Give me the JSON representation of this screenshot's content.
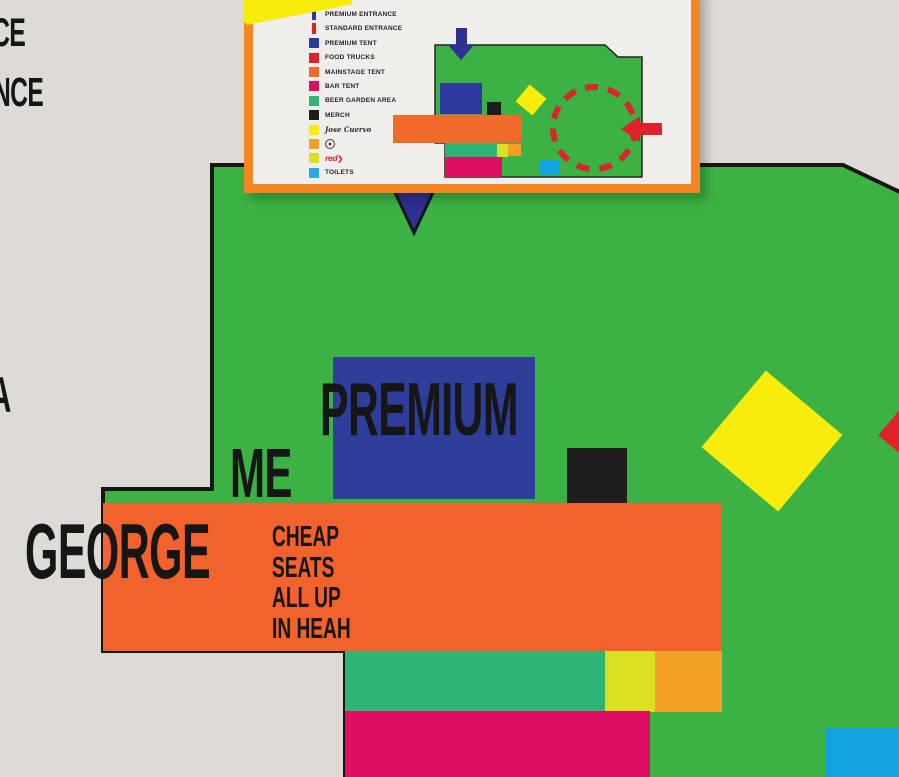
{
  "inset_legend": {
    "items": [
      {
        "label": "PREMIUM ENTRANCE",
        "swatch": "bar",
        "swatch_color": "#2c3a9e"
      },
      {
        "label": "STANDARD ENTRANCE",
        "swatch": "bar",
        "swatch_color": "#e0212a"
      },
      {
        "label": "PREMIUM TENT",
        "swatch": "square",
        "swatch_color": "#2c3a9e"
      },
      {
        "label": "FOOD TRUCKS",
        "swatch": "square",
        "swatch_color": "#e0212a"
      },
      {
        "label": "MAINSTAGE TENT",
        "swatch": "square",
        "swatch_color": "#f26a2b"
      },
      {
        "label": "BAR TENT",
        "swatch": "square",
        "swatch_color": "#e00e63"
      },
      {
        "label": "BEER GARDEN AREA",
        "swatch": "square",
        "swatch_color": "#2fb573"
      },
      {
        "label": "MERCH",
        "swatch": "square",
        "swatch_color": "#1c1c1c"
      },
      {
        "label": "Jose Cuervo",
        "swatch": "square",
        "swatch_color": "#f9ed0a",
        "type": "script-logo"
      },
      {
        "label": "",
        "swatch": "square",
        "swatch_color": "#f3a126",
        "type": "circle-logo"
      },
      {
        "label": "red",
        "swatch": "square",
        "swatch_color": "#d9e021",
        "type": "red-logo",
        "glyph": "❯",
        "logo_color": "#e0212a"
      },
      {
        "label": "TOILETS",
        "swatch": "square",
        "swatch_color": "#29abe2"
      }
    ]
  },
  "map_labels": {
    "premium": "PREMIUM",
    "me": "ME",
    "george": "GEORGE",
    "cheap_seats": [
      "CHEAP",
      "SEATS",
      "ALL UP",
      "IN HEAH"
    ]
  },
  "edge_text": {
    "line1": "CE",
    "line2": "NCE",
    "line3": "A"
  },
  "colors": {
    "background": "#dedbd7",
    "map_green": "#3cb244",
    "premium_blue": "#2e3e9a",
    "mainstage_orange": "#f2622d",
    "bar_magenta": "#e00e63",
    "beer_garden_teal": "#2fb573",
    "toilets_cyan": "#14a3e1",
    "cuervo_yellow": "#f8ec0c",
    "merch_black": "#1f1c1d",
    "accent_red": "#e0212a",
    "entrance_navy": "#2e3191",
    "inset_border_orange": "#f58521"
  }
}
